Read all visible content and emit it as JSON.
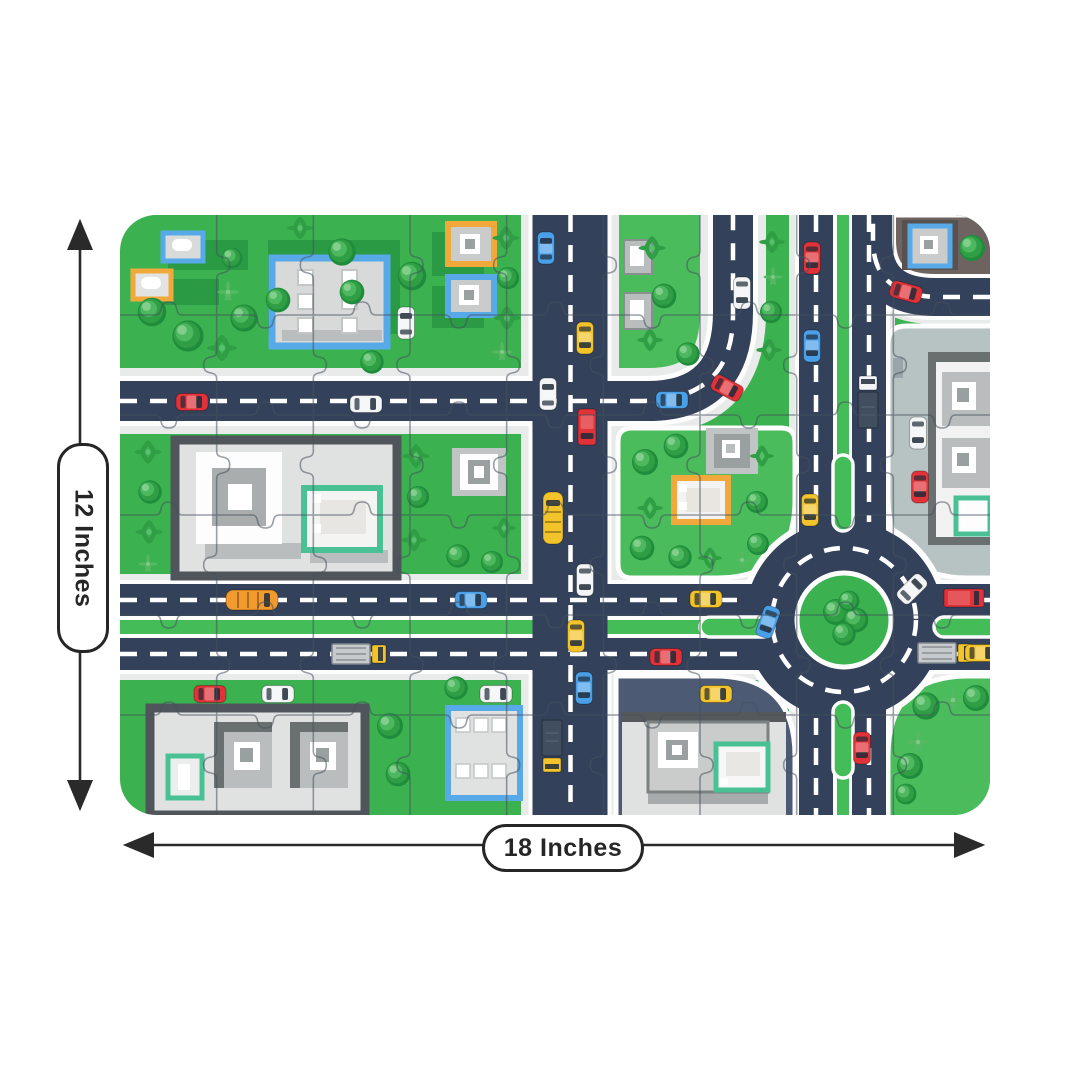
{
  "dimensions": {
    "height_label": "12 Inches",
    "width_label": "18 Inches"
  },
  "palette": {
    "grass": "#3bb24f",
    "grassLight": "#4abc5c",
    "road": "#33415a",
    "roadLine": "#ffffff",
    "sidewalk": "#e9ebeb",
    "median": "#44bd58",
    "plazaDark": "#4d5a73",
    "plazaLight": "#b7c2c2",
    "blockBrown": "#6e6360",
    "buildingLight": "#e0e2e1",
    "buildingMid": "#b9bdbd",
    "buildingDark": "#55595c",
    "frameBlue": "#57a9e8",
    "frameOrange": "#f2a93b",
    "frameTeal": "#49c195",
    "puzzleLine": "#46525e",
    "red": "#e03238",
    "yellow": "#f2c32a",
    "blue": "#4aa0e8",
    "white": "#f2f4f5",
    "orange": "#f29a2e",
    "gray": "#c9ccd0",
    "arrow": "#2a2a2a"
  },
  "scene": {
    "puzzle_grid": {
      "cols": 9,
      "rows": 6
    },
    "cars": [
      {
        "t": "car",
        "c": "red",
        "x": 192,
        "y": 402,
        "r": 90
      },
      {
        "t": "car",
        "c": "white",
        "x": 366,
        "y": 404,
        "r": 90
      },
      {
        "t": "car",
        "c": "white",
        "x": 406,
        "y": 323,
        "r": 0
      },
      {
        "t": "car",
        "c": "blue",
        "x": 546,
        "y": 248,
        "r": 0
      },
      {
        "t": "car",
        "c": "yellow",
        "x": 585,
        "y": 338,
        "r": 180
      },
      {
        "t": "car",
        "c": "white",
        "x": 548,
        "y": 394,
        "r": 0
      },
      {
        "t": "van",
        "c": "red",
        "x": 587,
        "y": 427,
        "r": 180
      },
      {
        "t": "bus",
        "c": "yellow",
        "x": 553,
        "y": 518,
        "r": 0
      },
      {
        "t": "car",
        "c": "white",
        "x": 585,
        "y": 580,
        "r": 180
      },
      {
        "t": "car",
        "c": "yellow",
        "x": 576,
        "y": 636,
        "r": 180
      },
      {
        "t": "car",
        "c": "blue",
        "x": 584,
        "y": 688,
        "r": 180
      },
      {
        "t": "truckD",
        "c": "yellow",
        "x": 552,
        "y": 746,
        "r": 180
      },
      {
        "t": "car",
        "c": "blue",
        "x": 672,
        "y": 400,
        "r": 90
      },
      {
        "t": "car",
        "c": "red",
        "x": 727,
        "y": 388,
        "r": 118
      },
      {
        "t": "car",
        "c": "white",
        "x": 742,
        "y": 293,
        "r": 180
      },
      {
        "t": "car",
        "c": "red",
        "x": 812,
        "y": 258,
        "r": 180
      },
      {
        "t": "car",
        "c": "blue",
        "x": 812,
        "y": 346,
        "r": 180
      },
      {
        "t": "truckD",
        "c": "white",
        "x": 868,
        "y": 402,
        "r": 0
      },
      {
        "t": "car",
        "c": "red",
        "x": 906,
        "y": 292,
        "r": 105
      },
      {
        "t": "bus",
        "c": "orange",
        "x": 252,
        "y": 600,
        "r": 90
      },
      {
        "t": "car",
        "c": "blue",
        "x": 471,
        "y": 600,
        "r": 90
      },
      {
        "t": "car",
        "c": "yellow",
        "x": 706,
        "y": 599,
        "r": 90
      },
      {
        "t": "car",
        "c": "blue",
        "x": 768,
        "y": 622,
        "r": 200
      },
      {
        "t": "car",
        "c": "white",
        "x": 912,
        "y": 589,
        "r": 45
      },
      {
        "t": "boxtruck",
        "c": "red",
        "x": 964,
        "y": 598,
        "r": 90
      },
      {
        "t": "truckL",
        "c": "yellow",
        "x": 360,
        "y": 654,
        "r": 90
      },
      {
        "t": "car",
        "c": "red",
        "x": 666,
        "y": 657,
        "r": 90
      },
      {
        "t": "truckL",
        "c": "yellow",
        "x": 946,
        "y": 653,
        "r": 90
      },
      {
        "t": "car",
        "c": "yellow",
        "x": 981,
        "y": 653,
        "r": 90
      },
      {
        "t": "car",
        "c": "yellow",
        "x": 810,
        "y": 510,
        "r": 180
      },
      {
        "t": "car",
        "c": "red",
        "x": 862,
        "y": 748,
        "r": 180
      },
      {
        "t": "car",
        "c": "red",
        "x": 210,
        "y": 694,
        "r": 90
      },
      {
        "t": "car",
        "c": "white",
        "x": 278,
        "y": 694,
        "r": 90
      },
      {
        "t": "car",
        "c": "white",
        "x": 496,
        "y": 694,
        "r": 90
      },
      {
        "t": "car",
        "c": "yellow",
        "x": 716,
        "y": 694,
        "r": 90
      },
      {
        "t": "car",
        "c": "white",
        "x": 918,
        "y": 433,
        "r": 180
      },
      {
        "t": "car",
        "c": "red",
        "x": 920,
        "y": 487,
        "r": 180
      }
    ],
    "trees": [
      {
        "t": "bush",
        "x": 152,
        "y": 312,
        "s": 1.1
      },
      {
        "t": "bush",
        "x": 188,
        "y": 336,
        "s": 1.2
      },
      {
        "t": "bush",
        "x": 244,
        "y": 318,
        "s": 1.05
      },
      {
        "t": "bush",
        "x": 278,
        "y": 300,
        "s": 0.95
      },
      {
        "t": "palm",
        "x": 222,
        "y": 348,
        "s": 1
      },
      {
        "t": "bush",
        "x": 232,
        "y": 258,
        "s": 0.8
      },
      {
        "t": "fern",
        "x": 228,
        "y": 292,
        "s": 0.9
      },
      {
        "t": "bush",
        "x": 342,
        "y": 252,
        "s": 1.05
      },
      {
        "t": "bush",
        "x": 352,
        "y": 292,
        "s": 0.95
      },
      {
        "t": "palm",
        "x": 300,
        "y": 228,
        "s": 0.85
      },
      {
        "t": "bush",
        "x": 412,
        "y": 276,
        "s": 1.1
      },
      {
        "t": "bush",
        "x": 372,
        "y": 362,
        "s": 0.9
      },
      {
        "t": "palm",
        "x": 506,
        "y": 238,
        "s": 0.9
      },
      {
        "t": "bush",
        "x": 508,
        "y": 278,
        "s": 0.85
      },
      {
        "t": "palm",
        "x": 507,
        "y": 318,
        "s": 0.9
      },
      {
        "t": "fern",
        "x": 502,
        "y": 352,
        "s": 0.85
      },
      {
        "t": "palm",
        "x": 652,
        "y": 248,
        "s": 0.9
      },
      {
        "t": "bush",
        "x": 664,
        "y": 296,
        "s": 0.95
      },
      {
        "t": "palm",
        "x": 650,
        "y": 340,
        "s": 0.85
      },
      {
        "t": "bush",
        "x": 688,
        "y": 354,
        "s": 0.9
      },
      {
        "t": "palm",
        "x": 772,
        "y": 242,
        "s": 0.85
      },
      {
        "t": "fern",
        "x": 773,
        "y": 277,
        "s": 0.8
      },
      {
        "t": "bush",
        "x": 771,
        "y": 312,
        "s": 0.85
      },
      {
        "t": "palm",
        "x": 769,
        "y": 350,
        "s": 0.85
      },
      {
        "t": "bush",
        "x": 972,
        "y": 248,
        "s": 1.0
      },
      {
        "t": "palm",
        "x": 148,
        "y": 452,
        "s": 0.9
      },
      {
        "t": "bush",
        "x": 150,
        "y": 492,
        "s": 0.9
      },
      {
        "t": "palm",
        "x": 149,
        "y": 532,
        "s": 0.9
      },
      {
        "t": "fern",
        "x": 148,
        "y": 564,
        "s": 0.8
      },
      {
        "t": "palm",
        "x": 416,
        "y": 456,
        "s": 0.9
      },
      {
        "t": "bush",
        "x": 418,
        "y": 497,
        "s": 0.85
      },
      {
        "t": "palm",
        "x": 414,
        "y": 540,
        "s": 0.85
      },
      {
        "t": "bush",
        "x": 458,
        "y": 556,
        "s": 0.9
      },
      {
        "t": "bush",
        "x": 492,
        "y": 562,
        "s": 0.85
      },
      {
        "t": "palm",
        "x": 504,
        "y": 528,
        "s": 0.8
      },
      {
        "t": "bush",
        "x": 645,
        "y": 462,
        "s": 1.0
      },
      {
        "t": "bush",
        "x": 676,
        "y": 446,
        "s": 0.95
      },
      {
        "t": "palm",
        "x": 650,
        "y": 508,
        "s": 0.85
      },
      {
        "t": "bush",
        "x": 642,
        "y": 548,
        "s": 0.95
      },
      {
        "t": "bush",
        "x": 680,
        "y": 557,
        "s": 0.9
      },
      {
        "t": "palm",
        "x": 710,
        "y": 558,
        "s": 0.8
      },
      {
        "t": "palm",
        "x": 762,
        "y": 456,
        "s": 0.8
      },
      {
        "t": "bush",
        "x": 757,
        "y": 502,
        "s": 0.85
      },
      {
        "t": "fern",
        "x": 742,
        "y": 560,
        "s": 0.8
      },
      {
        "t": "bush",
        "x": 758,
        "y": 544,
        "s": 0.85
      },
      {
        "t": "bush",
        "x": 836,
        "y": 612,
        "s": 1.0
      },
      {
        "t": "bush",
        "x": 856,
        "y": 620,
        "s": 0.95
      },
      {
        "t": "bush",
        "x": 844,
        "y": 634,
        "s": 0.9
      },
      {
        "t": "bush",
        "x": 849,
        "y": 601,
        "s": 0.8
      },
      {
        "t": "bush",
        "x": 926,
        "y": 706,
        "s": 1.05
      },
      {
        "t": "fern",
        "x": 953,
        "y": 700,
        "s": 0.9
      },
      {
        "t": "bush",
        "x": 976,
        "y": 698,
        "s": 1.0
      },
      {
        "t": "fern",
        "x": 918,
        "y": 742,
        "s": 0.9
      },
      {
        "t": "bush",
        "x": 910,
        "y": 766,
        "s": 1.0
      },
      {
        "t": "bush",
        "x": 906,
        "y": 794,
        "s": 0.8
      },
      {
        "t": "bush",
        "x": 390,
        "y": 726,
        "s": 1.0
      },
      {
        "t": "bush",
        "x": 398,
        "y": 774,
        "s": 0.95
      },
      {
        "t": "bush",
        "x": 456,
        "y": 688,
        "s": 0.9
      }
    ]
  }
}
